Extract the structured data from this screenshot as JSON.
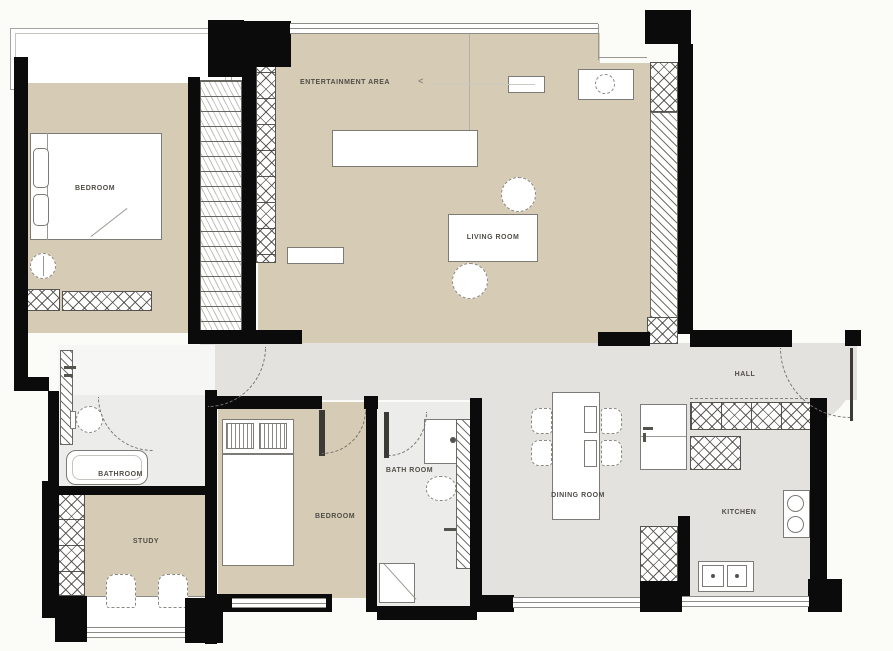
{
  "plan_title": "apartment-floor-plan",
  "colors": {
    "wall": "#0b0b0b",
    "floor_beige": "#d6cbb5",
    "floor_gray": "#e3e2df",
    "floor_light": "#ececea",
    "background": "#fbfbf8"
  },
  "rooms": {
    "bedroom_master": {
      "label": "BEDROOM"
    },
    "entertainment": {
      "label": "ENTERTAINMENT AREA"
    },
    "living": {
      "label": "LIVING ROOM"
    },
    "hall": {
      "label": "HALL"
    },
    "bathroom_master": {
      "label": "BATHROOM"
    },
    "study": {
      "label": "STUDY"
    },
    "bedroom_second": {
      "label": "BEDROOM"
    },
    "bathroom_second": {
      "label": "BATH ROOM"
    },
    "dining": {
      "label": "DINING ROOM"
    },
    "kitchen": {
      "label": "KITCHEN"
    }
  },
  "annotations": {
    "entertainment_arrow": "<"
  }
}
